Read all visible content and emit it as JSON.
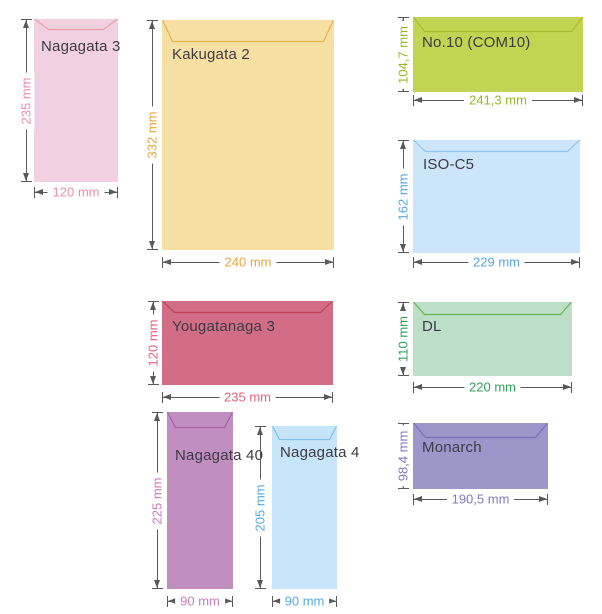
{
  "theme": {
    "background": "#FFFFFF",
    "name_text_color": "#3E3A45",
    "dimension_line_color": "#58595B"
  },
  "envelopes": [
    {
      "name": "Nagagata 3",
      "height_label": "235 mm",
      "width_label": "120 mm",
      "colors": {
        "fill": "#F0D0E1",
        "flap_line": "#EB9FA7",
        "dimension_text": "#EC8CA9"
      },
      "geometry": {
        "left": 34,
        "top": 19,
        "width": 84,
        "height": 163,
        "flap_depth": 11,
        "flap_inset": 14,
        "label_dx": 7,
        "label_dy": 20,
        "vdim_x": 26,
        "hdim_y": 192
      }
    },
    {
      "name": "Kakugata 2",
      "height_label": "332 mm",
      "width_label": "240 mm",
      "colors": {
        "fill": "#F6DFA2",
        "flap_line": "#E5B44E",
        "dimension_text": "#E9A53E"
      },
      "geometry": {
        "left": 162,
        "top": 20,
        "width": 172,
        "height": 230,
        "flap_depth": 22,
        "flap_inset": 10,
        "label_dx": 10,
        "label_dy": 27,
        "vdim_x": 152,
        "hdim_y": 262
      }
    },
    {
      "name": "No.10 (COM10)",
      "height_label": "104,7 mm",
      "width_label": "241,3 mm",
      "colors": {
        "fill": "#C3D452",
        "flap_line": "#A6BE2F",
        "dimension_text": "#96B923"
      },
      "geometry": {
        "left": 413,
        "top": 17,
        "width": 170,
        "height": 75,
        "flap_depth": 15,
        "flap_inset": 11,
        "label_dx": 9,
        "label_dy": 18,
        "vdim_x": 403,
        "hdim_y": 100
      }
    },
    {
      "name": "ISO-C5",
      "height_label": "162 mm",
      "width_label": "229 mm",
      "colors": {
        "fill": "#CCE5F9",
        "flap_line": "#90C5EF",
        "dimension_text": "#58A7DD"
      },
      "geometry": {
        "left": 413,
        "top": 140,
        "width": 167,
        "height": 113,
        "flap_depth": 12,
        "flap_inset": 12,
        "label_dx": 10,
        "label_dy": 17,
        "vdim_x": 403,
        "hdim_y": 262
      }
    },
    {
      "name": "Yougatanaga 3",
      "height_label": "120 mm",
      "width_label": "235 mm",
      "colors": {
        "fill": "#D16E86",
        "flap_line": "#C23E58",
        "dimension_text": "#E56180"
      },
      "geometry": {
        "left": 162,
        "top": 301,
        "width": 171,
        "height": 84,
        "flap_depth": 12,
        "flap_inset": 12,
        "label_dx": 10,
        "label_dy": 18,
        "vdim_x": 153,
        "hdim_y": 397
      }
    },
    {
      "name": "DL",
      "height_label": "110 mm",
      "width_label": "220 mm",
      "colors": {
        "fill": "#BDDFC7",
        "flap_line": "#69B44E",
        "dimension_text": "#2FA05C"
      },
      "geometry": {
        "left": 413,
        "top": 302,
        "width": 159,
        "height": 74,
        "flap_depth": 13,
        "flap_inset": 11,
        "label_dx": 9,
        "label_dy": 17,
        "vdim_x": 403,
        "hdim_y": 387
      }
    },
    {
      "name": "Nagagata 40",
      "height_label": "225 mm",
      "width_label": "90 mm",
      "colors": {
        "fill": "#C08FC0",
        "flap_line": "#A263A8",
        "dimension_text": "#CB7ABF"
      },
      "geometry": {
        "left": 167,
        "top": 412,
        "width": 66,
        "height": 177,
        "flap_depth": 16,
        "flap_inset": 8,
        "label_dx": 8,
        "label_dy": 36,
        "vdim_x": 157,
        "hdim_y": 601
      }
    },
    {
      "name": "Nagagata 4",
      "height_label": "205 mm",
      "width_label": "90 mm",
      "colors": {
        "fill": "#C7E5F8",
        "flap_line": "#7EC2F0",
        "dimension_text": "#55A9DF"
      },
      "geometry": {
        "left": 272,
        "top": 426,
        "width": 65,
        "height": 163,
        "flap_depth": 14,
        "flap_inset": 7,
        "label_dx": 8,
        "label_dy": 19,
        "vdim_x": 260,
        "hdim_y": 601
      }
    },
    {
      "name": "Monarch",
      "height_label": "98,4 mm",
      "width_label": "190,5 mm",
      "colors": {
        "fill": "#9D96CB",
        "flap_line": "#7A71B5",
        "dimension_text": "#8279BE"
      },
      "geometry": {
        "left": 413,
        "top": 423,
        "width": 135,
        "height": 66,
        "flap_depth": 15,
        "flap_inset": 12,
        "label_dx": 9,
        "label_dy": 17,
        "vdim_x": 403,
        "hdim_y": 499
      }
    }
  ]
}
